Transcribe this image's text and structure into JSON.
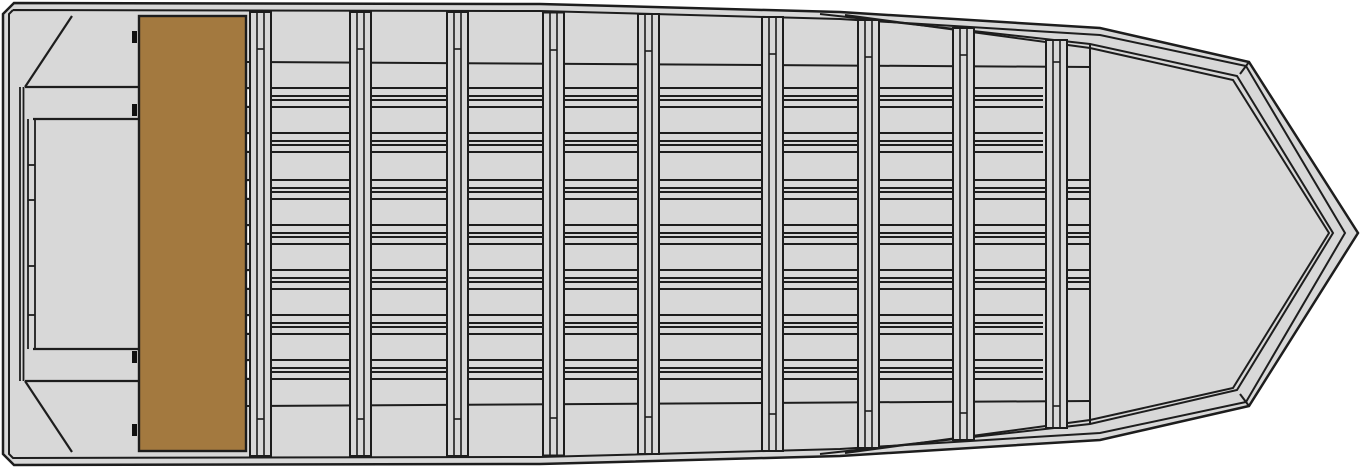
{
  "diagram": {
    "type": "boat-plan-view",
    "subject": "flat-bottom jon boat, top deck plan view, bow pointing right",
    "canvas": {
      "width": 1366,
      "height": 468
    }
  },
  "colors": {
    "background": "#ffffff",
    "hull_fill": "#d8d8d8",
    "line": "#1d1d1d",
    "seat_fill": "#a3793f",
    "gap_fill": "#ffffff",
    "hinge_mark": "#111111"
  },
  "hull": {
    "outer_path": "M 14 3 L 540 4 L 840 12 L 1100 28 L 1249 62 L 1358 233 L 1249 406 L 1100 440 L 840 456 L 540 464 L 14 465 L 3 454 L 3 14 Z",
    "inner_path": "M 13 10 L 540 11 L 840 19 L 1100 35 L 1246 66 L 1345 233 L 1246 402 L 1100 433 L 840 449 L 540 457 L 13 458 L 9 454 L 9 14 L 13 10",
    "sheer_lip_paths": [
      "M 820 14 L 1090 44 L 1237 76 L 1333 233 L 1237 390 L 1090 424 L 820 454",
      "M 845 15 L 1090 48 L 1233 80 L 1329 233 L 1233 388 L 1090 420 L 845 453"
    ],
    "knuckle_seams": [
      [
        1249,
        62,
        1240,
        74
      ],
      [
        1249,
        406,
        1240,
        394
      ]
    ],
    "bow_deck_edge": [
      1090,
      44,
      1090,
      424
    ],
    "chine_lines": [
      [
        247,
        62,
        1090,
        67
      ],
      [
        247,
        406,
        1090,
        401
      ]
    ]
  },
  "stringers": {
    "rows_y": [
      88,
      133,
      180,
      225,
      270,
      315,
      360
    ],
    "line_offsets": [
      0,
      8,
      12,
      19
    ],
    "x_start": 247,
    "x_end_full": 1089,
    "x_end_short": 1043,
    "short_row_indexes": [
      0,
      1,
      5,
      6
    ],
    "seat_gap_blocks": {
      "x": 247,
      "width": 4,
      "dy": 2,
      "height": 15
    }
  },
  "ribs": {
    "count": 9,
    "width": 21,
    "x_positions": [
      250,
      350,
      447,
      543,
      638,
      762,
      858,
      953,
      1046
    ],
    "top_y": [
      12,
      12,
      12,
      12.5,
      14,
      17,
      20,
      28,
      40
    ],
    "bottom_y": [
      456,
      456,
      456,
      455.5,
      454,
      451,
      448,
      440,
      428
    ],
    "cap_top_y": [
      49,
      49,
      49,
      50,
      51,
      54,
      57,
      55,
      62
    ],
    "cap_bottom_y": [
      419,
      419,
      419,
      418,
      417,
      414,
      411,
      413,
      406
    ]
  },
  "transom": {
    "inner_lines_x": [
      20,
      23.5
    ],
    "inner_lines_y": [
      87,
      381
    ],
    "gussets": [
      [
        72,
        16,
        25,
        87
      ],
      [
        25,
        381,
        72,
        452
      ]
    ],
    "shelf_lines": [
      [
        25,
        87,
        139,
        87
      ],
      [
        33,
        119,
        139,
        119
      ],
      [
        33,
        349,
        139,
        349
      ],
      [
        25,
        381,
        139,
        381
      ]
    ],
    "ladder": {
      "x1": 28,
      "x2": 35,
      "y1": 119,
      "y2": 349,
      "rungs_y": [
        165,
        200,
        266,
        315
      ]
    }
  },
  "seat": {
    "x": 139,
    "y": 16,
    "width": 107,
    "height": 435,
    "hinge_marks": {
      "x": 132,
      "width": 5,
      "height": 12,
      "y_positions": [
        31,
        104,
        351,
        424
      ]
    }
  }
}
